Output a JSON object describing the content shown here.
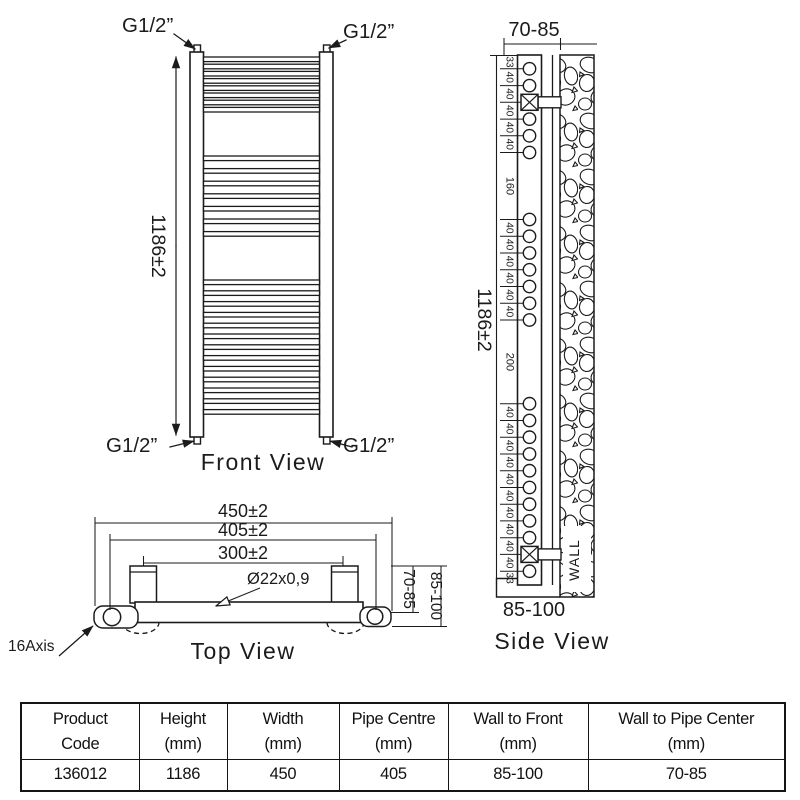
{
  "front_view": {
    "caption": "Front View",
    "height_dim": "1186±2",
    "fitting_top_left": "G1/2”",
    "fitting_top_right": "G1/2”",
    "fitting_bottom_left": "G1/2”",
    "fitting_bottom_right": "G1/2”",
    "bar_groups": [
      8,
      7,
      13
    ]
  },
  "top_view": {
    "caption": "Top View",
    "overall_width": "450±2",
    "pipe_centres": "405±2",
    "bracket_centres": "300±2",
    "tube_spec": "Ø22x0,9",
    "wall_to_pipe": "70-85",
    "wall_to_front": "85-100",
    "axis_label": "16Axis"
  },
  "side_view": {
    "caption": "Side View",
    "height_dim": "1186±2",
    "wall_to_pipe": "70-85",
    "wall_to_front": "85-100",
    "wall_label": "WALL",
    "chain": [
      "33",
      "40",
      "40",
      "40",
      "40",
      "40",
      "160",
      "40",
      "40",
      "40",
      "40",
      "40",
      "40",
      "200",
      "40",
      "40",
      "40",
      "40",
      "40",
      "40",
      "40",
      "40",
      "40",
      "40",
      "33"
    ],
    "bracket_circle_indices": [
      2,
      22
    ]
  },
  "table": {
    "columns": [
      {
        "l1": "Product",
        "l2": "Code",
        "value": "136012"
      },
      {
        "l1": "Height",
        "l2": "(mm)",
        "value": "1186"
      },
      {
        "l1": "Width",
        "l2": "(mm)",
        "value": "450"
      },
      {
        "l1": "Pipe Centre",
        "l2": "(mm)",
        "value": "405"
      },
      {
        "l1": "Wall to Front",
        "l2": "(mm)",
        "value": "85-100"
      },
      {
        "l1": "Wall to Pipe Center",
        "l2": "(mm)",
        "value": "70-85"
      }
    ]
  },
  "colors": {
    "ink": "#1b1b1b",
    "paper": "#ffffff"
  }
}
